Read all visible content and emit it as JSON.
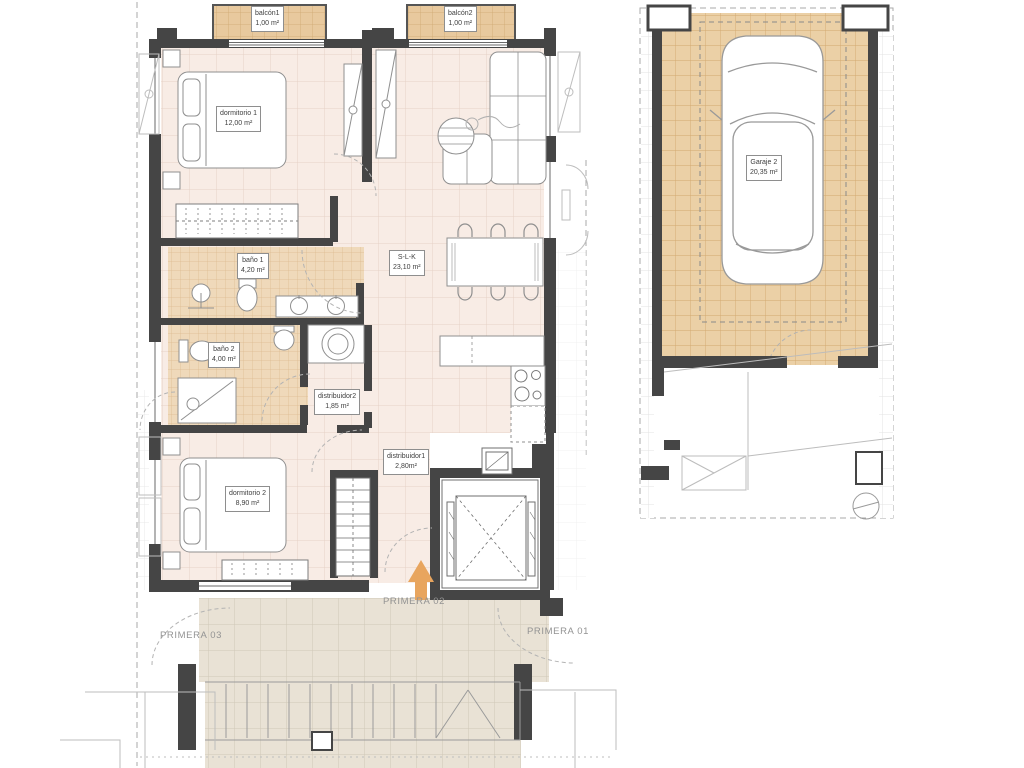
{
  "drawing": {
    "type": "residential floor plan with garage plan",
    "colors": {
      "wall": "#454545",
      "floor_interior": "#f8ece5",
      "tile_bath": "#efd9ba",
      "tile_balcony": "#e8c99e",
      "tile_garage": "#ebd0a6",
      "tile_terrace": "#e9e2d5",
      "arrow_accent": "#e8a55e",
      "label_text": "#3f3f3f",
      "level_text": "#939393"
    }
  },
  "apartment": {
    "rooms": {
      "balcon1": {
        "label": "balcón1",
        "area": "1,00 m²"
      },
      "balcon2": {
        "label": "balcón2",
        "area": "1,00 m²"
      },
      "dormitorio1": {
        "label": "dormitorio 1",
        "area": "12,00 m²"
      },
      "bano1": {
        "label": "baño 1",
        "area": "4,20 m²"
      },
      "slk": {
        "label": "S-L-K",
        "area": "23,10 m²"
      },
      "bano2": {
        "label": "baño 2",
        "area": "4,00 m²"
      },
      "distribuidor2": {
        "label": "distribuidor2",
        "area": "1,85 m²"
      },
      "distribuidor1": {
        "label": "distribuidor1",
        "area": "2,80m²"
      },
      "dormitorio2": {
        "label": "dormitorio 2",
        "area": "8,90 m²"
      }
    },
    "levels": {
      "primera03": "PRIMERA 03",
      "primera02": "PRIMERA 02",
      "primera01": "PRIMERA 01"
    }
  },
  "garage": {
    "rooms": {
      "garaje2": {
        "label": "Garaje 2",
        "area": "20,35 m²"
      }
    }
  }
}
